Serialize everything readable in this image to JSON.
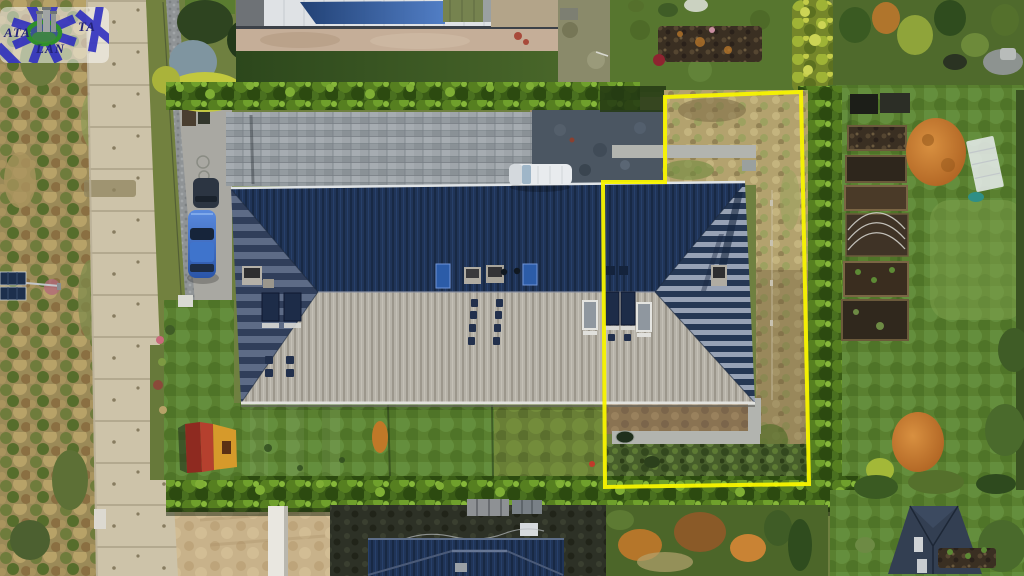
{
  "watermark": {
    "text_left": "ATA",
    "text_right": "TA",
    "text_bottom": "LAN",
    "star_color": "#2b2bbf",
    "ring_color": "#2f8f2b",
    "text_color": "#232379"
  },
  "property_outline": {
    "color": "#f8f400",
    "stroke_width": 4,
    "points": "665,97 801,92 809,484 605,487 603,182 665,182"
  },
  "palette": {
    "roof_north_navy": "#203457",
    "roof_south_grey": "#b6b2a8",
    "road_concrete": "#cdc3a9",
    "driveway_pavers": "#9aa1a6",
    "shadow_pavers": "#4b5662",
    "lawn_green": "#5a8030",
    "hedge_green": "#3a5c16",
    "dry_grass": "#b3a26e",
    "sand": "#c8b28a",
    "car_blue": "#3a6fd0",
    "van_white": "#e8ebee",
    "playhouse_red": "#a63326",
    "playhouse_yellow": "#d69a2b"
  },
  "objects": [
    {
      "name": "main-house",
      "desc": "long hip-roof building, navy north slope, grey south slope"
    },
    {
      "name": "property-boundary-outline",
      "desc": "yellow plot outline around right unit"
    },
    {
      "name": "street-road",
      "desc": "concrete slab road, left side"
    },
    {
      "name": "blue-car",
      "desc": "blue car parked at west end"
    },
    {
      "name": "dark-car",
      "desc": "dark car parked at west end"
    },
    {
      "name": "white-van",
      "desc": "white van on paver driveway"
    },
    {
      "name": "playhouse",
      "desc": "small red/yellow kids playhouse"
    },
    {
      "name": "garden-beds",
      "desc": "raised vegetable beds, right garden"
    },
    {
      "name": "agency-watermark-logo",
      "desc": "semi-transparent agency logo, top-left"
    }
  ]
}
